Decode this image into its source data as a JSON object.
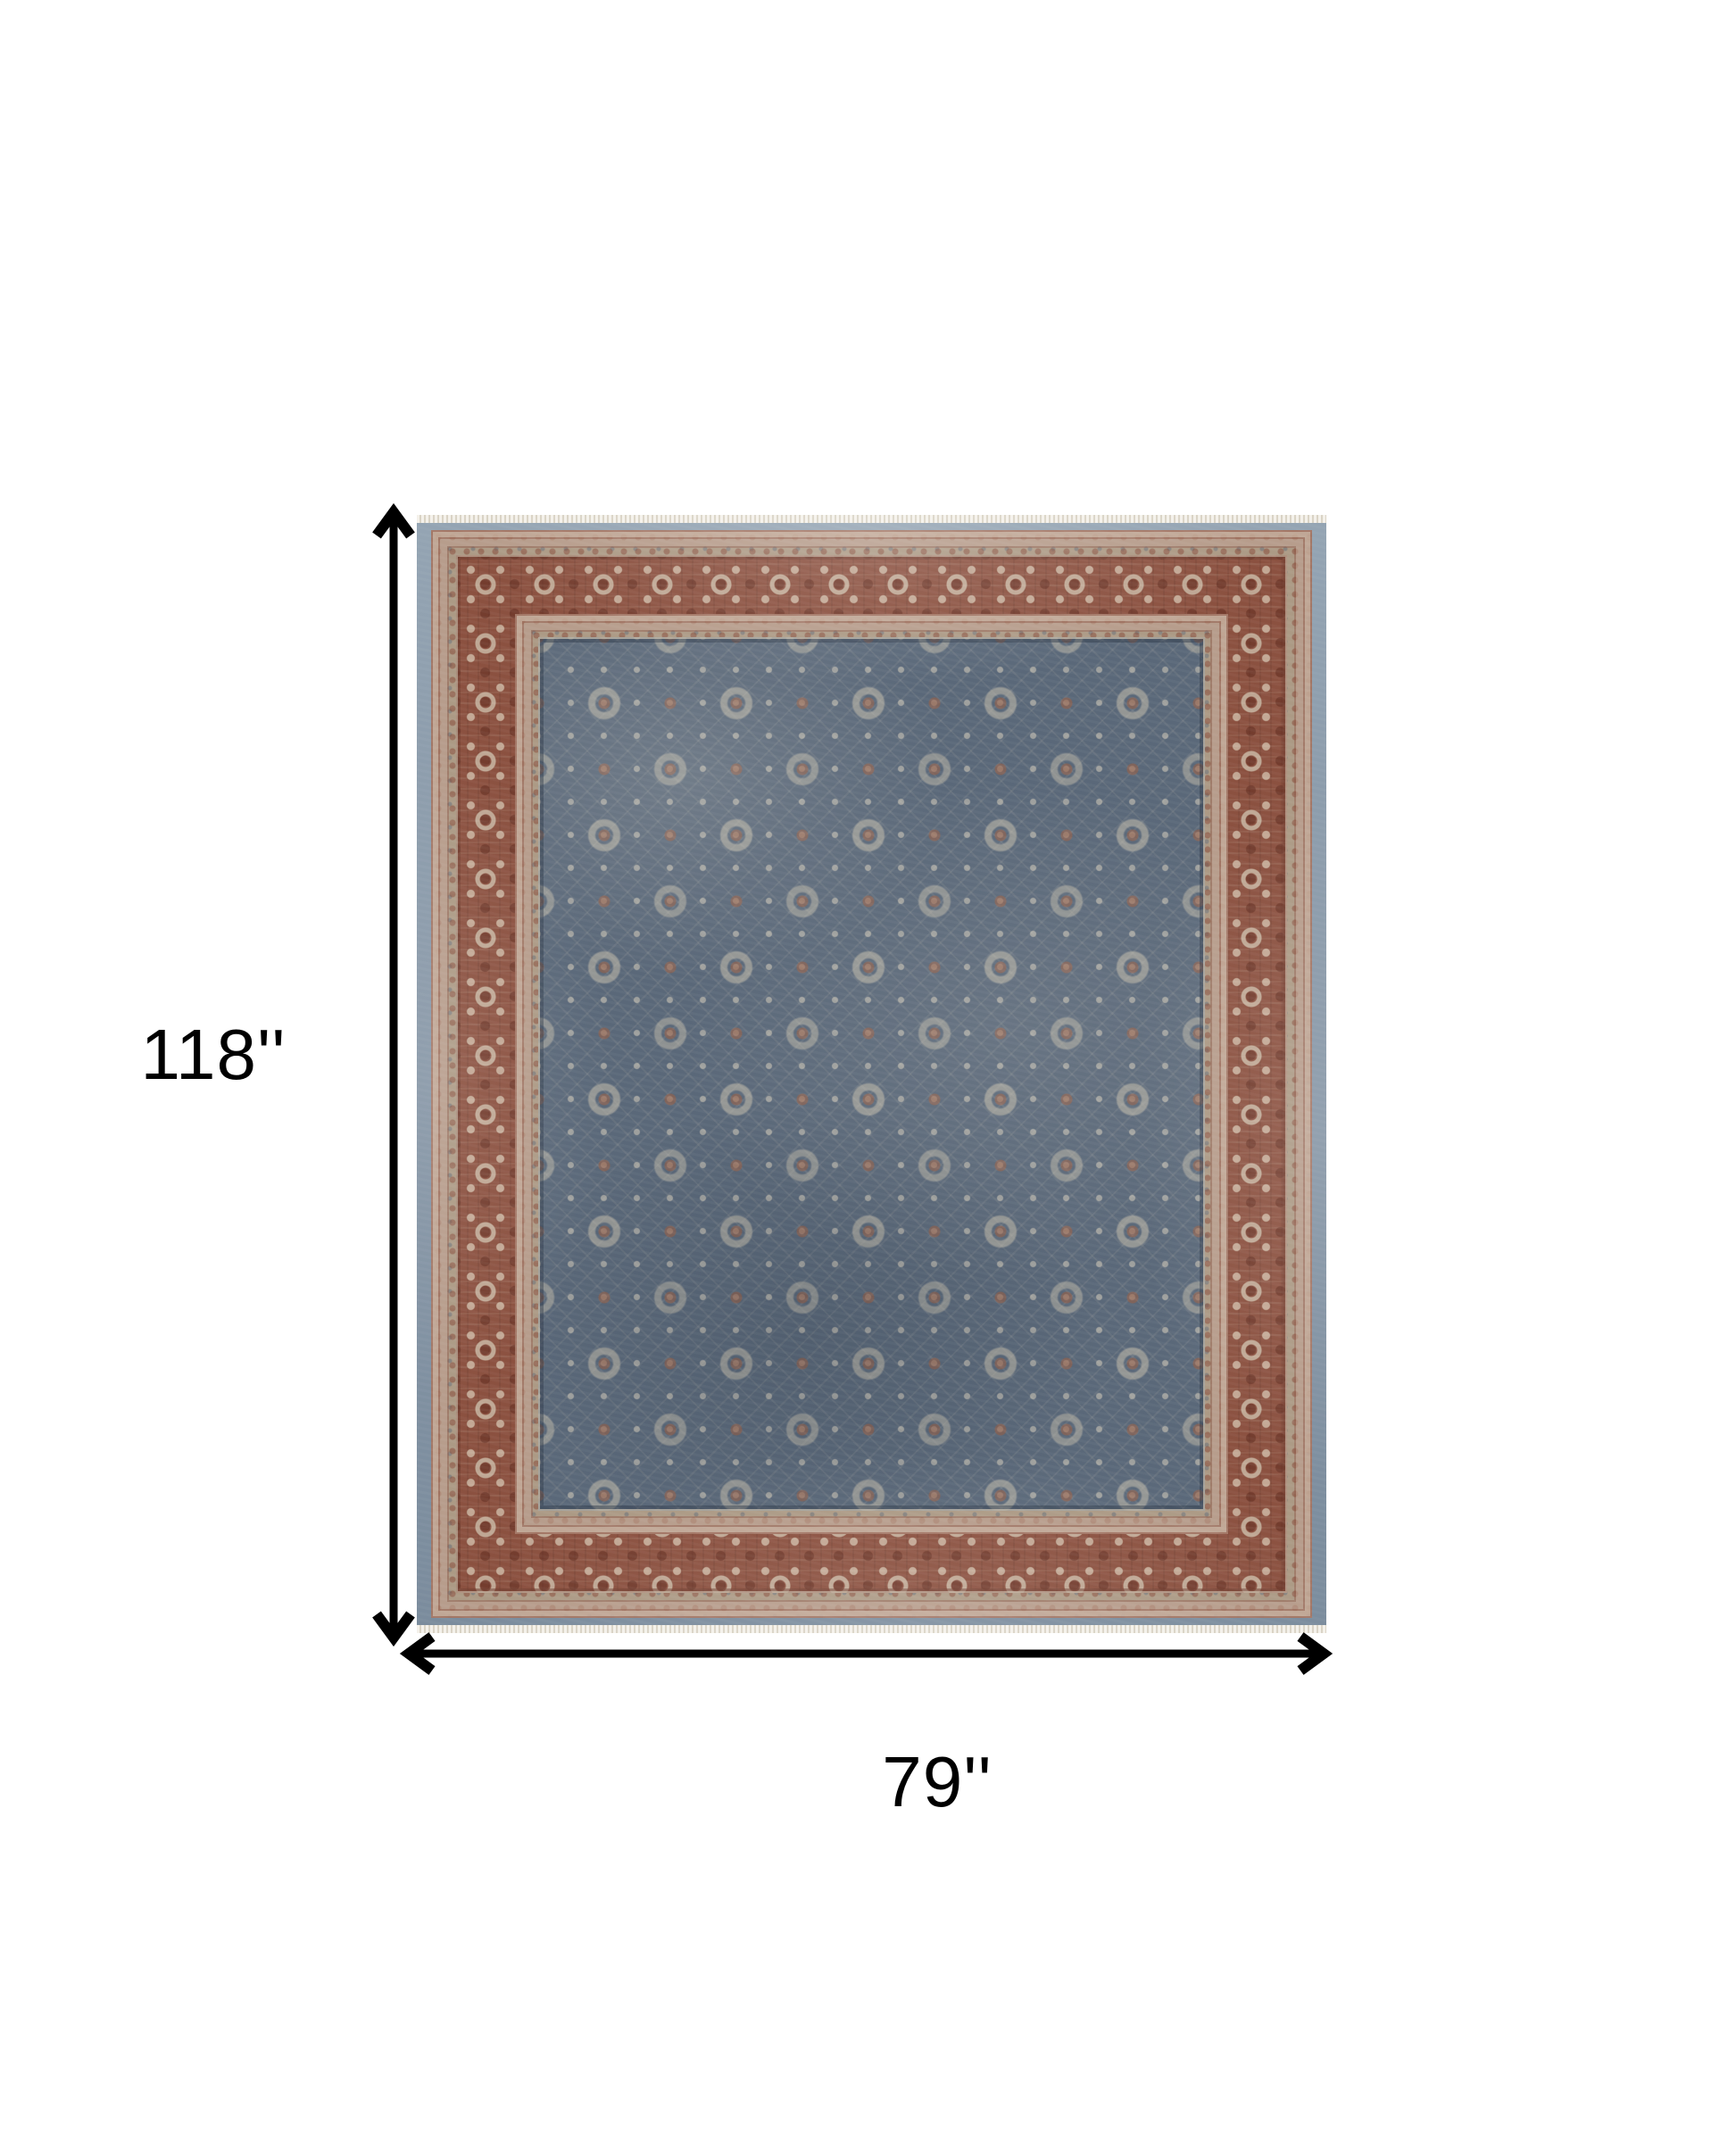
{
  "image": {
    "type": "product-dimension-diagram",
    "subject": "Distressed vintage Persian-style area rug, blue-gray floral field with rust red border",
    "background": "#ffffff"
  },
  "dimensions": {
    "height_label": "118''",
    "width_label": "79''"
  },
  "icons": {
    "height_arrow": "vertical-double-headed-arrow",
    "width_arrow": "horizontal-double-headed-arrow"
  },
  "colors": {
    "arrow": "#000000",
    "label_text": "#000000",
    "rug_field_blue": "#5a6879",
    "rug_border_rust": "#8b5140",
    "rug_motif_ivory": "#cdc5af",
    "rug_outer_band_blue": "#8696a6",
    "rug_guard_tan": "#ac9a85",
    "rug_fringe": "#f2efe8"
  }
}
